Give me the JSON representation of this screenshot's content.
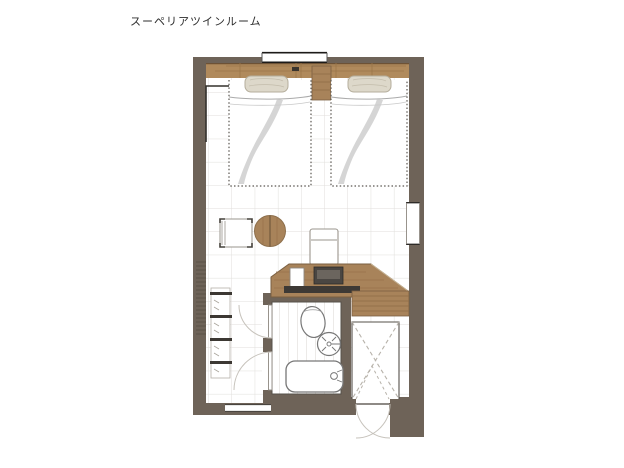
{
  "title": "スーペリアツインルーム",
  "palette": {
    "background": "#ffffff",
    "wall": "#6e6358",
    "wood": "#a8835a",
    "wood_grain": "#8f6c45",
    "headboard": "#b08a5c",
    "pillow": "#ddd8ca",
    "tile_grid": "#e0dedb",
    "fixture_stroke": "#777777",
    "dash_line": "#b7b2aa",
    "tv_dark": "#3d3935",
    "title_text": "#2d2d2d"
  },
  "plan": {
    "room_type": "twin",
    "features": [
      {
        "name": "window-top"
      },
      {
        "name": "headboard"
      },
      {
        "name": "bed-1"
      },
      {
        "name": "bed-2"
      },
      {
        "name": "nightstand"
      },
      {
        "name": "side-chair"
      },
      {
        "name": "round-table"
      },
      {
        "name": "desk-chair"
      },
      {
        "name": "desk"
      },
      {
        "name": "tv"
      },
      {
        "name": "luggage-bench"
      },
      {
        "name": "wall-panel-mirror"
      },
      {
        "name": "open-shelves"
      },
      {
        "name": "bathroom"
      },
      {
        "name": "toilet"
      },
      {
        "name": "sink"
      },
      {
        "name": "bathtub"
      },
      {
        "name": "closet"
      },
      {
        "name": "entrance-door"
      }
    ]
  }
}
